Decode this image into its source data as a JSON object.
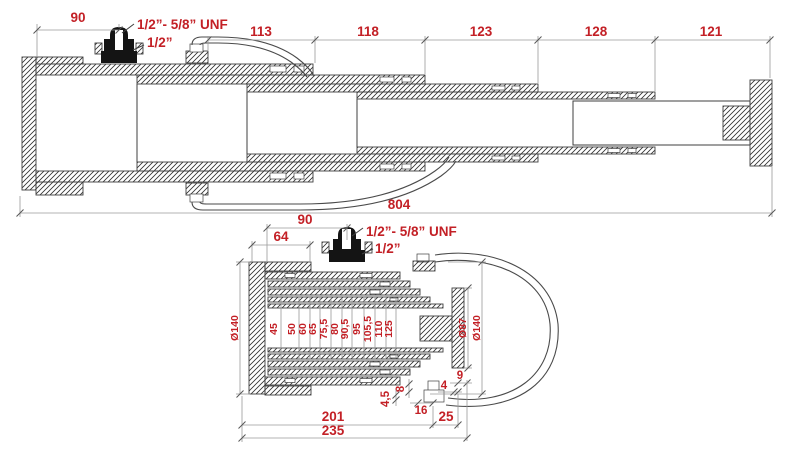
{
  "drawing": {
    "title": "telescopic-cylinder-technical-drawing",
    "colors": {
      "dimension_text": "#c32026",
      "drawing_line": "#3f3f3f",
      "dimension_line": "#9a9a9a",
      "background": "#ffffff",
      "fitting_fill": "#141414"
    },
    "top_view": {
      "dim_90": "90",
      "stage_dims": [
        "113",
        "118",
        "123",
        "128",
        "121"
      ],
      "dim_total": "804",
      "port_thread_label": "1/2”- 5/8” UNF",
      "port_size_label": "1/2”"
    },
    "section_view": {
      "dim_90": "90",
      "dim_64": "64",
      "port_thread_label": "1/2”- 5/8” UNF",
      "port_size_label": "1/2”",
      "outer_diameter_label": "Ø140",
      "bore_diameters": [
        "45",
        "50",
        "60",
        "65",
        "75,5",
        "80",
        "90,5",
        "95",
        "105,5",
        "110",
        "125"
      ],
      "rod_diameter_label": "Ø87",
      "right_outer_diameter_label": "Ø140",
      "dim_4_5": "4,5",
      "dim_8": "8",
      "dim_16": "16",
      "dim_4": "4",
      "dim_9": "9",
      "dim_25": "25",
      "dim_201": "201",
      "dim_235": "235"
    }
  }
}
